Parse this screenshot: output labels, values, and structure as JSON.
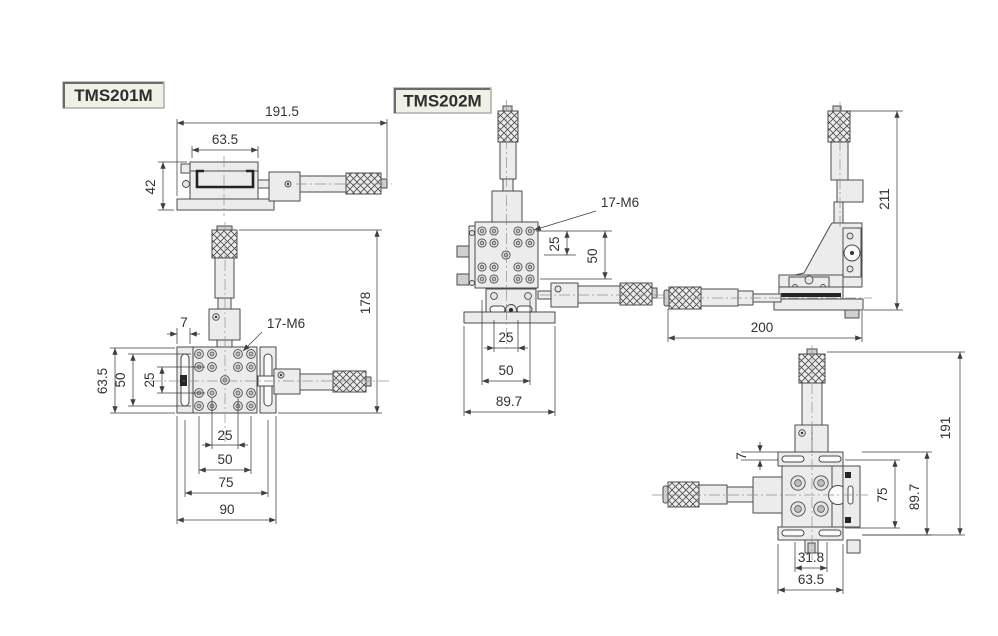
{
  "page": {
    "background": "#ffffff"
  },
  "colors": {
    "part_fill": "#ececec",
    "part_stroke": "#4b4b4b",
    "dimension_lines": "#3f3f3f",
    "dimension_text": "#323232",
    "label_box_fill": "#eff0e6",
    "label_box_border": "#9a9a9a"
  },
  "products": {
    "tms201m": {
      "label": "TMS201M",
      "side_view": {
        "dim_overall_length": "191.5",
        "dim_top_width": "63.5",
        "dim_height": "42"
      },
      "plan_view": {
        "dim_slot": "7",
        "hole_callout": "17-M6",
        "dim_overall_height": "178",
        "dim_left_outer": "63.5",
        "dim_left_mid": "50",
        "dim_left_inner": "25",
        "dim_bottom_inner": "25",
        "dim_bottom_mid": "50",
        "dim_bottom_outer": "75",
        "dim_bottom_full": "90"
      }
    },
    "tms202m": {
      "label": "TMS202M",
      "front_view": {
        "hole_callout": "17-M6",
        "dim_right_inner": "25",
        "dim_right_outer": "50",
        "dim_bottom_inner": "25",
        "dim_bottom_mid": "50",
        "dim_bottom_full": "89.7"
      },
      "side_view": {
        "dim_height": "211",
        "dim_length": "200"
      },
      "top_view": {
        "dim_slot": "7",
        "dim_right_inner": "75",
        "dim_right_mid": "89.7",
        "dim_right_full": "191",
        "dim_bottom_inner": "31.8",
        "dim_bottom_full": "63.5"
      }
    }
  }
}
